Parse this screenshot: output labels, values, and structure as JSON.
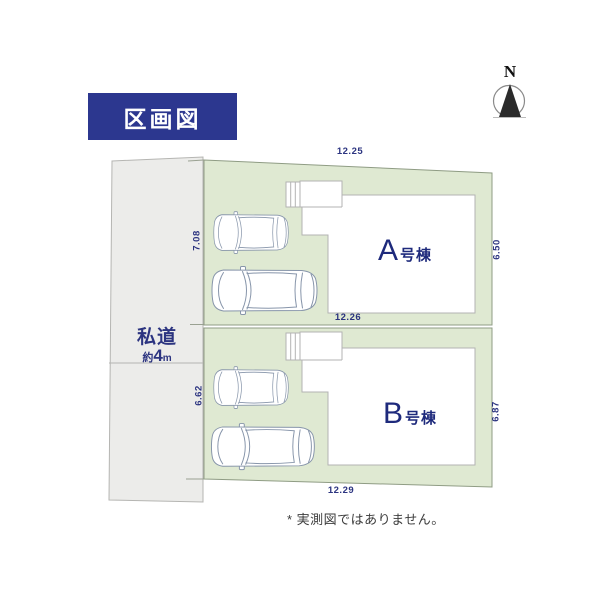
{
  "title": "区画図",
  "compass": {
    "label": "N"
  },
  "road": {
    "name": "私道",
    "approx": "約",
    "size": "4",
    "unit": "m"
  },
  "houses": {
    "a": "A号棟",
    "b": "B号棟"
  },
  "dimensions": {
    "plot_a_top": "12.25",
    "plot_boundary": "12.26",
    "plot_b_bottom": "12.29",
    "plot_a_left": "7.08",
    "plot_a_right": "6.50",
    "plot_b_left": "6.62",
    "plot_b_right": "6.87"
  },
  "footnote": "* 実測図ではありません。",
  "colors": {
    "title_bg": "#2c378f",
    "ink": "#2c3480",
    "plot_fill": "#dfe9d2",
    "plot_stroke": "#8f9c84",
    "road_fill": "#ececea",
    "road_stroke": "#b5b5b2",
    "house_stroke": "#b3b3b3",
    "car_stroke": "#8795aa",
    "compass_needle": "#2b2b2b",
    "footnote_ink": "#3c3c3c"
  }
}
